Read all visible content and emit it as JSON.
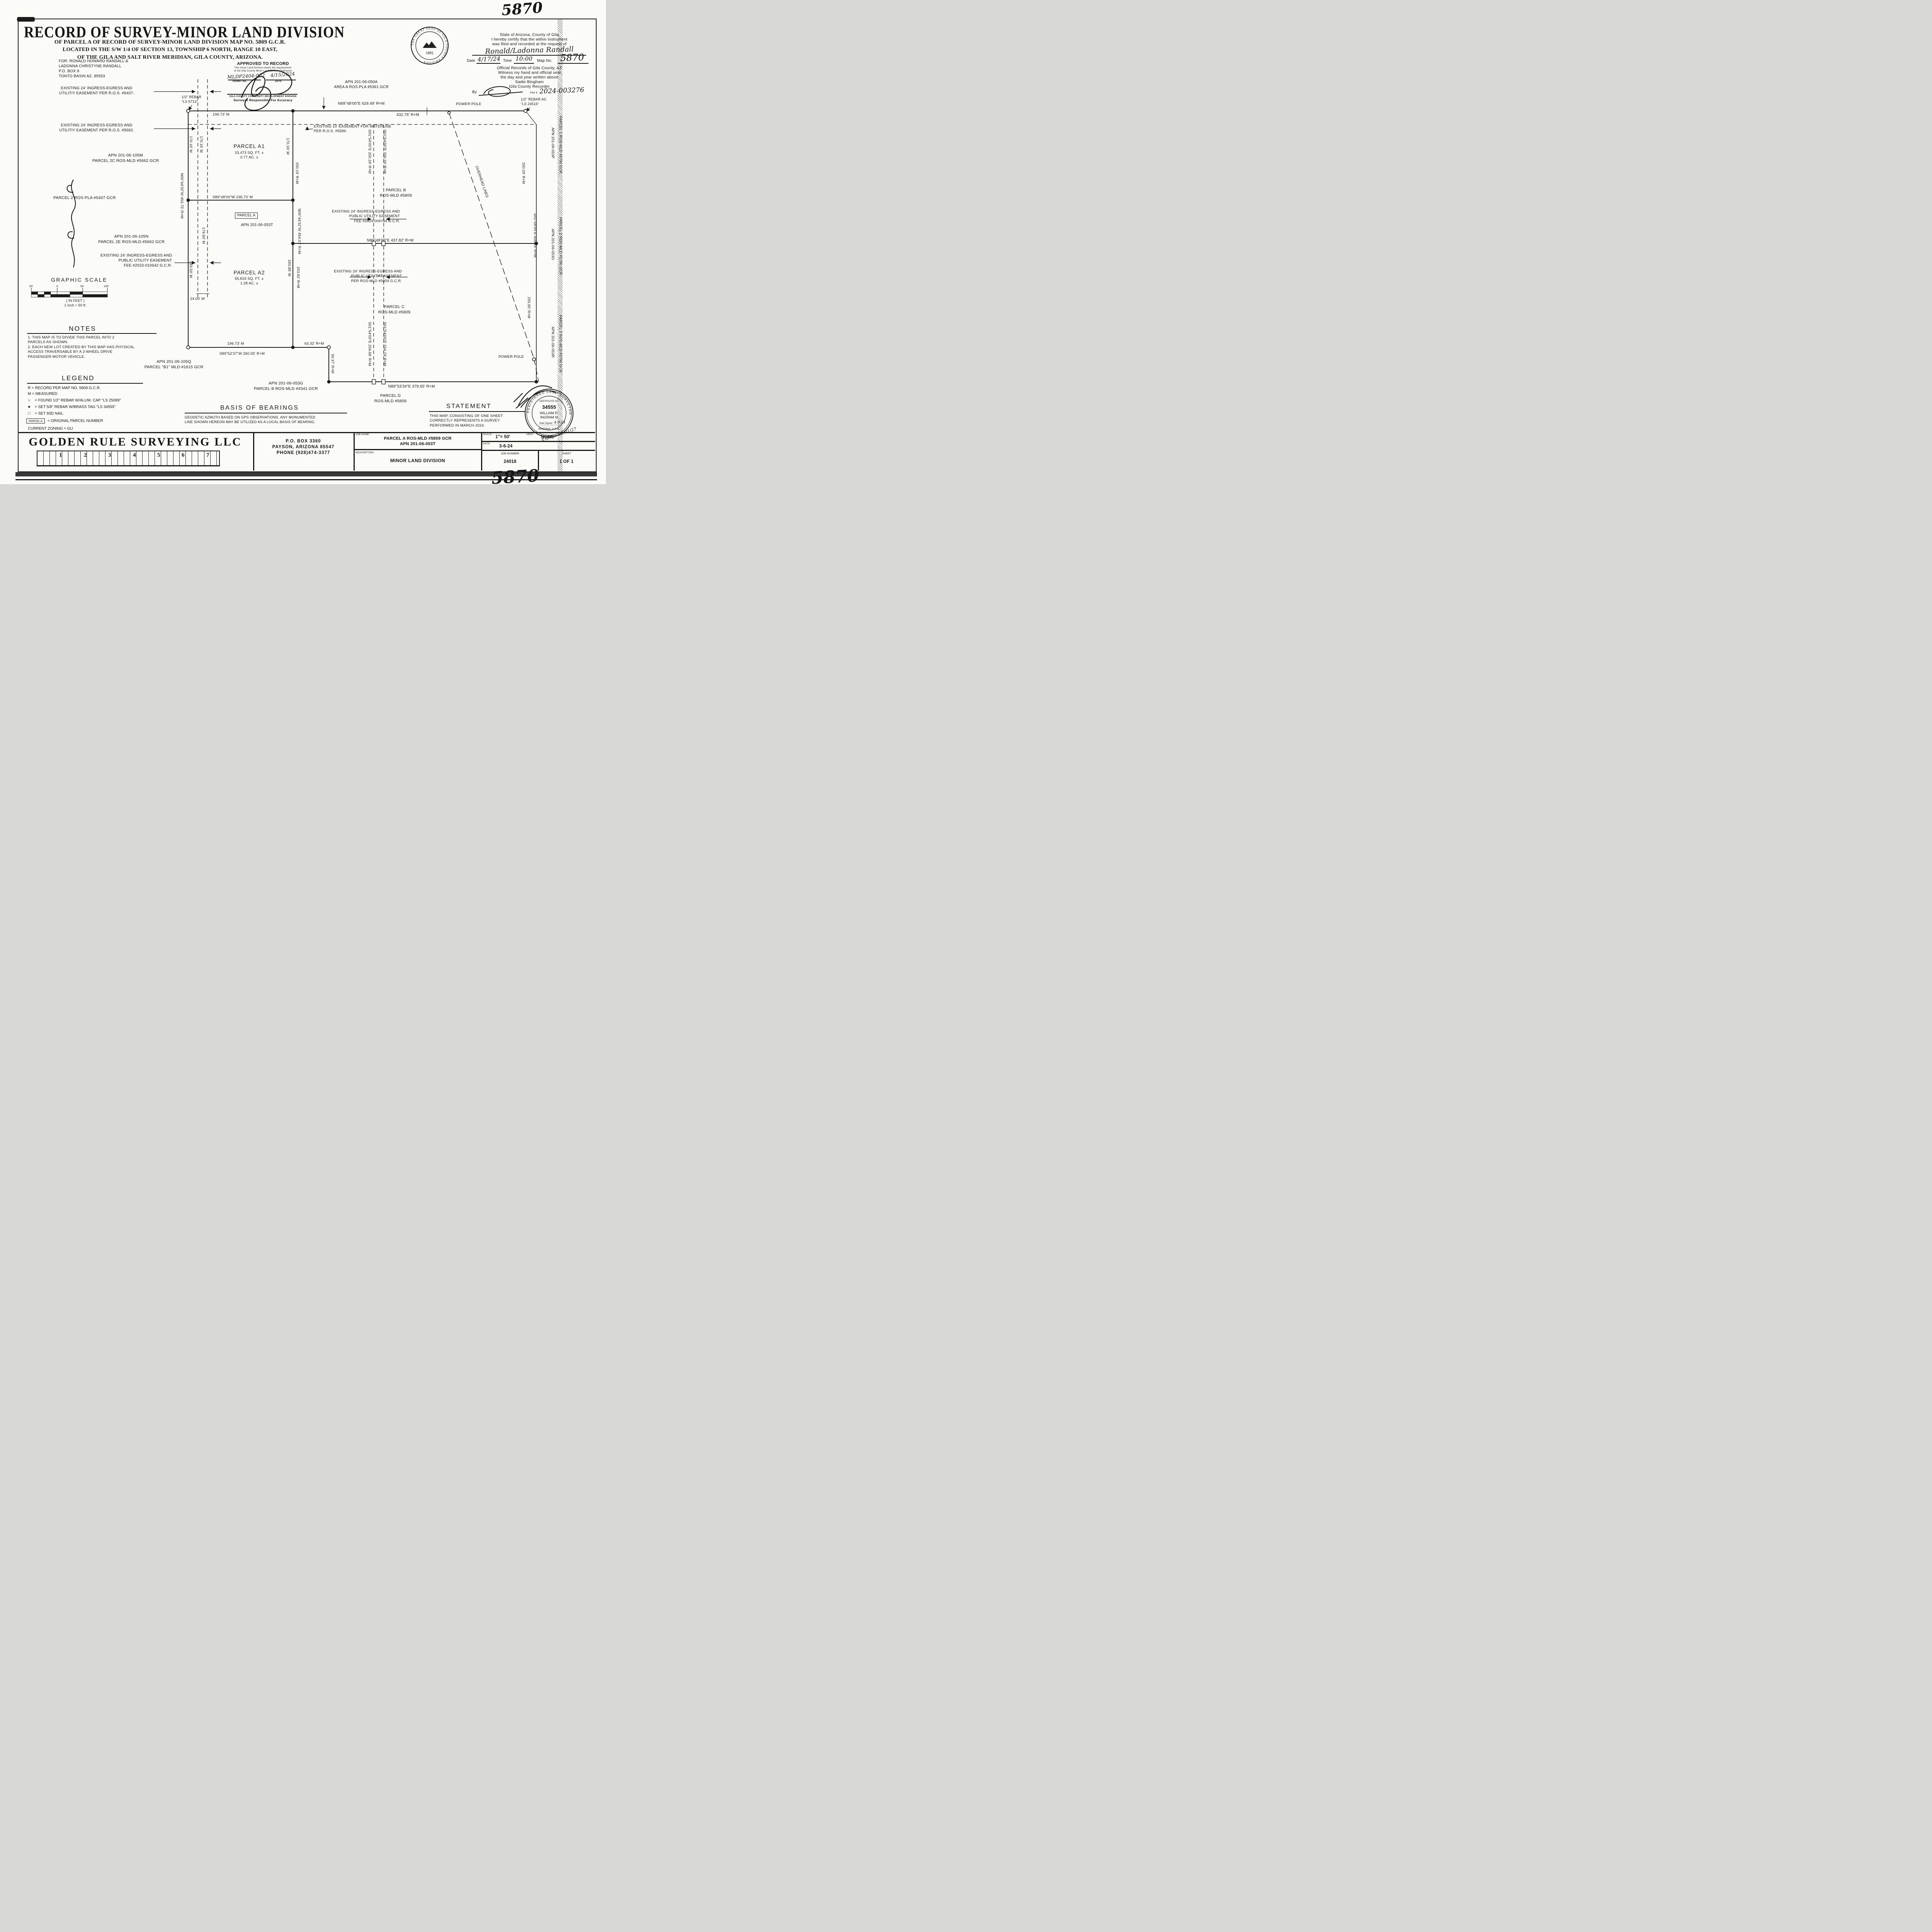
{
  "handwritten": {
    "top_number": "5870",
    "bottom_number": "5870"
  },
  "title": {
    "line1": "RECORD OF SURVEY-MINOR LAND DIVISION",
    "line2": "OF PARCEL A OF RECORD OF SURVEY-MINOR LAND DIVISION MAP NO. 5809 G.C.R.",
    "line3": "LOCATED IN THE S/W 1/4 OF SECTION 13, TOWNSHIP 6 NORTH, RANGE 10 EAST,",
    "line4": "OF THE GILA AND SALT RIVER MERIDIAN, GILA COUNTY, ARIZONA."
  },
  "for_block": "FOR: RONALD HOWARD RANDALL &\n LADONNA CHRISTYNE RANDALL\n P.O. BOX 9\n TONTO BASIN AZ. 85553",
  "approved": {
    "heading": "APPROVED TO RECORD",
    "line1": "This minor Land Division meets the requirements",
    "line2": "of the Gila County Minor Land Division Ordinance",
    "permit_value": "MLDP2404-002",
    "date_value": "4/15/2024",
    "permit_label": "PERMIT NO.",
    "date_label": "DATE",
    "division": "GILA COUNTY COMMUNITY DEVELOPMENT DIVISION",
    "accuracy": "Surveyor Responsible For Accuracy"
  },
  "county_seal": {
    "ring_text": "THE GREAT SEAL OF GILA COUNTY ARIZONA",
    "year": "1881"
  },
  "recorder": {
    "line1": "State of Arizona, County of Gila",
    "line2": "I hereby certify that the within instrument",
    "line3": "was filed and recorded at the request of",
    "requestor": "Ronald/Ladonna Randall",
    "date_label": "Date",
    "date_value": "4/17/24",
    "time_label": "Time",
    "time_value": "10:00",
    "map_label": "Map No.",
    "map_value": "5870",
    "line4": "Official Records of Gila County, AZ",
    "line5": "Witness my hand and official seal",
    "line6": "the day and year written above",
    "line7": "Sadie Bingham",
    "line8": "Gila County Recorder",
    "by_label": "By",
    "fee_label": "Fee #",
    "fee_value": "2024-003276"
  },
  "map": {
    "easement_5407": "EXISTING 24' INGRESS-EGRESS AND\nUTILITIY EASEMENT PER R.O.S. #5407.",
    "easement_5662": "EXISTING 24' INGRESS-EGRESS AND\nUTILITIY EASEMENT PER R.O.S. #5662.",
    "apn_105m": "APN 201-06-105M\nPARCEL 2C ROS-MLD #5662 GCR",
    "parcel2_pla": "PARCEL 2 ROS-PLA #5407 GCR",
    "apn_105n": "APN 201-06-105N\nPARCEL 2E ROS-MLD #5662 GCR",
    "easement_010642": "EXISTING 24' INGRESS-EGRESS AND\nPUBLIC UTILITY EASEMENT\nFEE #2023-010642 G.C.R.",
    "apn_105q": "APN 201-06-105Q\nPARCEL \"B1\" MLD #1615 GCR",
    "apn_053g": "APN 201-06-053G\nPARCEL B ROS-MLD #4341 GCR",
    "apn_050a": "APN 201-06-050A\nAREA A ROS-PLA #5361 GCR",
    "rebar_5713": "1/2\" REBAR\n\"LS 5713\"",
    "rebar_24516": "1/2\" REBAR AC\n\"LS 24516\"",
    "power_pole_top": "POWER POLE",
    "power_pole_bottom": "POWER POLE",
    "waterline": "EXISTING 10' EASEMENT FOR WATERLINE\nPER R.O.S. #5589.",
    "overhead": "OVERHEAD LINES",
    "parcel_a1": "PARCEL A1",
    "parcel_a1_area": "33,473 SQ. FT. ±\n0.77 AC. ±",
    "parcel_a_box": "PARCEL A",
    "parcel_a_apn": "APN 201-06-053T",
    "parcel_a2": "PARCEL A2",
    "parcel_a2_area": "55,815 SQ. FT. ±\n1.28 AC. ±",
    "parcel_b": "PARCEL B\nROS-MLD #5809",
    "parcel_c": "PARCEL C\nROS-MLD #5809",
    "parcel_d": "PARCEL D\nROS-MLD #5809",
    "easement_009794": "EXISTING 24' INGRESS-EGRESS AND\nPUBLIC UTILITY EASEMENT\nFEE #2023-009794 G.C.R.",
    "easement_5809": "EXISTING 24' INGRESS-EGRESS AND\nPUBLIC UTILITY EASEMENT\nPER ROS-MLD #5809 G.C.R.",
    "dim_629_49": "N89°48'00\"E 629.49' R+M",
    "dim_432_76": "432.76' R+M",
    "dim_196_73_top": "196.73' M",
    "dim_196_73_bottom": "196.73' M",
    "dim_s89_196_73": "S89°48'00\"W 196.73' M",
    "dim_437_82": "N89°48'00\"E 437.82' R+M",
    "dim_s89_260_05": "S89°52'37\"W 260.05' R+M",
    "dim_63_32": "63.32' R+M",
    "dim_50_37": "50.37' R+M",
    "dim_379_65": "N89°53'34\"E 379.65' R+M",
    "dim_24ft": "24'",
    "dim_24_00": "24.00' M",
    "v_170_16_a": "170.16' M",
    "v_170_16_b": "170.16' M",
    "v_170_16_c": "170.16' M",
    "v_250_19": "250.19' R+M",
    "v_n00_453_75": "N00°44'32\"W 453.75' R+M",
    "v_179_93": "179.93' M",
    "v_283_59": "283.59' M",
    "v_n00_454_01": "N00°44'32\"W 454.01' R+M",
    "v_283_86": "283.86' M",
    "v_203_82": "203.82' R+M",
    "v_s01_250_29_a": "S01°54'00\"E 250.29' R+M",
    "v_s01_250_29_b": "S01°54'00\"E 250.29' R+M",
    "v_s01_254_66": "S01°54'00\"E 254.66' R+M",
    "v_s01_254_79": "S01°54'00\"E 254.79' R+M",
    "v_250_29_r": "250.29' R+M",
    "v_s01_505_29": "S01°54'00\"E 505.29' R+M",
    "v_255_00": "255.00' R+M",
    "apn_053p_1": "APN 201-06-053P",
    "apn_053p_2": "PARCEL 1 ROS-MLD #5790 GCR",
    "apn_053o_1": "APN 201-06-053O",
    "apn_053o_2": "PARCEL 2 ROS-MLD #5790 GCR",
    "apn_053r_1": "APN 201-06-053R",
    "apn_053r_2": "PARCEL 3 ROS-MLD #5790 GCR"
  },
  "graphic_scale": {
    "heading": "GRAPHIC SCALE",
    "ticks": [
      "50",
      "0",
      "50",
      "100"
    ],
    "unit": "( IN FEET )",
    "ratio": "1 inch = 50  ft."
  },
  "notes": {
    "heading": "NOTES",
    "body": "1. THIS MAP IS TO DIVIDE THIS PARCEL INTO 2\nPARCELS AS SHOWN.\n2. EACH NEW LOT CREATED BY THIS MAP HAS PHYSICAL\nACCESS TRAVERSABLE BY A 2-WHEEL DRIVE\nPASSENGER MOTOR VEHICLE."
  },
  "legend": {
    "heading": "LEGEND",
    "r_line": "R = RECORD PER MAP NO. 5809 G.C.R.",
    "m_line": "M = MEASURED",
    "sym_found": "○",
    "found": "= FOUND 1/2\" REBAR W/ALUM. CAP \"LS 25089\"",
    "sym_set": "●",
    "set": "= SET 5/8\" REBAR W/BRASS TAG \"LS 34555\"",
    "sym_nail": "□",
    "nail": "= SET 60D NAIL",
    "parcel_box": "PARCEL A",
    "original": "= ORIGINAL PARCEL NUMBER",
    "zoning": "CURRENT ZONING = GU"
  },
  "basis": {
    "heading": "BASIS OF BEARINGS",
    "body": "GEODETIC AZMUTH BASED ON GPS OBSERVATIONS.  ANY MONUMENTED\nLINE SHOWN HEREON MAY BE UTILIZED AS A LOCAL BASIS OF BEARING."
  },
  "statement": {
    "heading": "STATEMENT",
    "body": "THIS MAP, CONSISTING OF ONE SHEET\nCORRECTLY REPRESENTS A SURVEY\nPERFORMED IN MARCH 2024."
  },
  "surveyor_seal": {
    "ring_top": "REGISTERED LAND SURVEYOR",
    "cert_label": "CERTIFICATE NO.",
    "number": "34555",
    "name_line1": "WILLIAM R.",
    "name_line2": "INGRAM III",
    "signed_label": "Date Signed",
    "signed_value": "4-9-24",
    "state": "ARIZONA, U.S.A.",
    "expires": "Expires 03/31/27"
  },
  "titleblock": {
    "company": "GOLDEN RULE SURVEYING LLC",
    "ruler": [
      "1",
      "2",
      "3",
      "4",
      "5",
      "6",
      "7"
    ],
    "address": "P.O. BOX 3360\nPAYSON, ARIZONA 85547\nPHONE (928)474-3377",
    "job_name_label": "JOB NAME:",
    "job_name": "PARCEL A ROS-MLD #5809 GCR\nAPN 201-06-053T",
    "description_label": "DESCRIPTION:",
    "description": "MINOR LAND DIVISION",
    "scale_label": "SCALE:",
    "scale_value": "1\"= 50'",
    "vert_label": "VERT:",
    "vert_value": "NONE",
    "date_label": "DATE:",
    "date_value": "3-6-24",
    "job_number_label": "JOB NUMBER",
    "job_number": "24018",
    "sheet_label": "SHEET",
    "sheet_value": "1 OF 1"
  }
}
